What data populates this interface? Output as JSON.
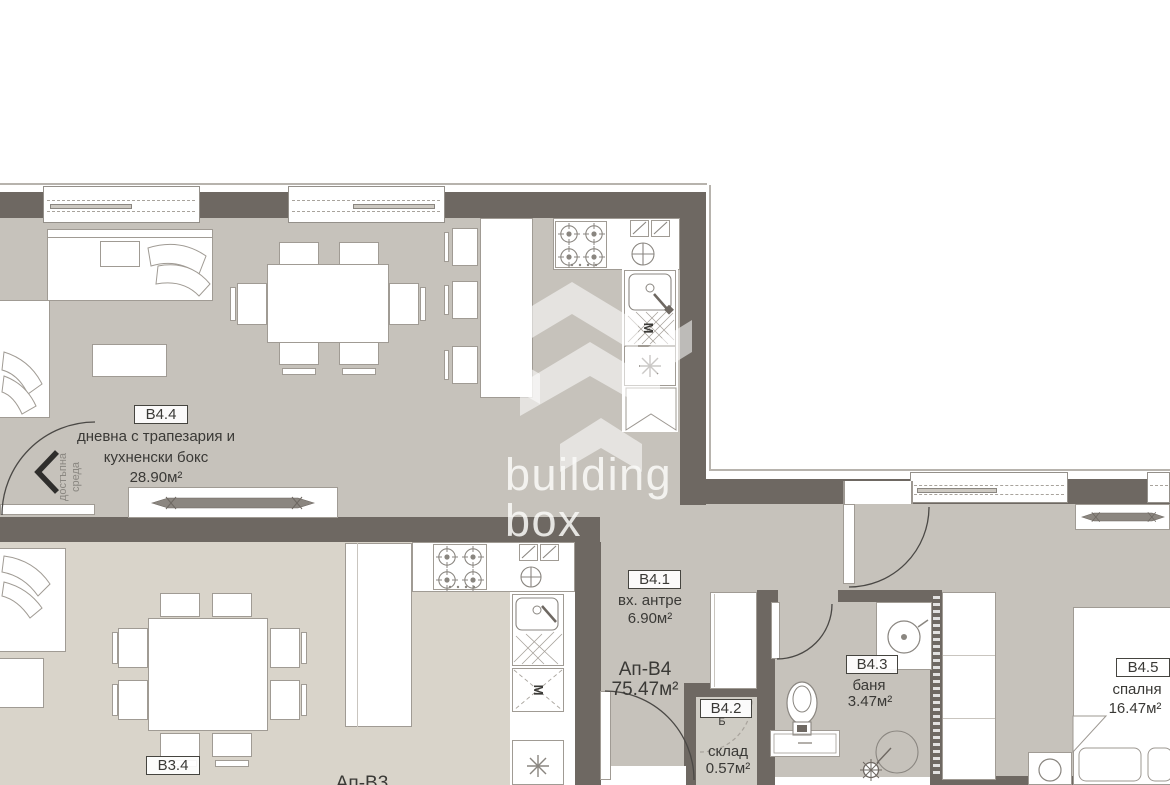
{
  "plan": {
    "watermark": {
      "line1": "building",
      "line2": "box"
    },
    "accessibility": {
      "line1": "достъпна",
      "line2": "среда"
    },
    "apartment": {
      "name": "Ап-В4",
      "area": "75.47м²"
    },
    "neighbor_apartment": {
      "name": "Ап-В3"
    },
    "rooms": {
      "living": {
        "id": "B4.4",
        "name1": "дневна с трапезария и",
        "name2": "кухненски бокс",
        "area": "28.90м²"
      },
      "hall": {
        "id": "B4.1",
        "name": "вх. антре",
        "area": "6.90м²"
      },
      "storage": {
        "id": "B4.2",
        "tag": "Б",
        "name": "склад",
        "area": "0.57м²"
      },
      "bathroom": {
        "id": "B4.3",
        "name": "баня",
        "area": "3.47м²"
      },
      "bedroom": {
        "id": "B4.5",
        "name": "спалня",
        "area": "16.47м²"
      },
      "neighbor_room": {
        "id": "B3.4"
      }
    },
    "symbols": {
      "washing_machine": "M"
    },
    "colors": {
      "wall": "#6e6862",
      "floor_main": "#c6c2bb",
      "floor_neighbor": "#d9d4ca",
      "floor_storage": "#cfccc4"
    }
  }
}
